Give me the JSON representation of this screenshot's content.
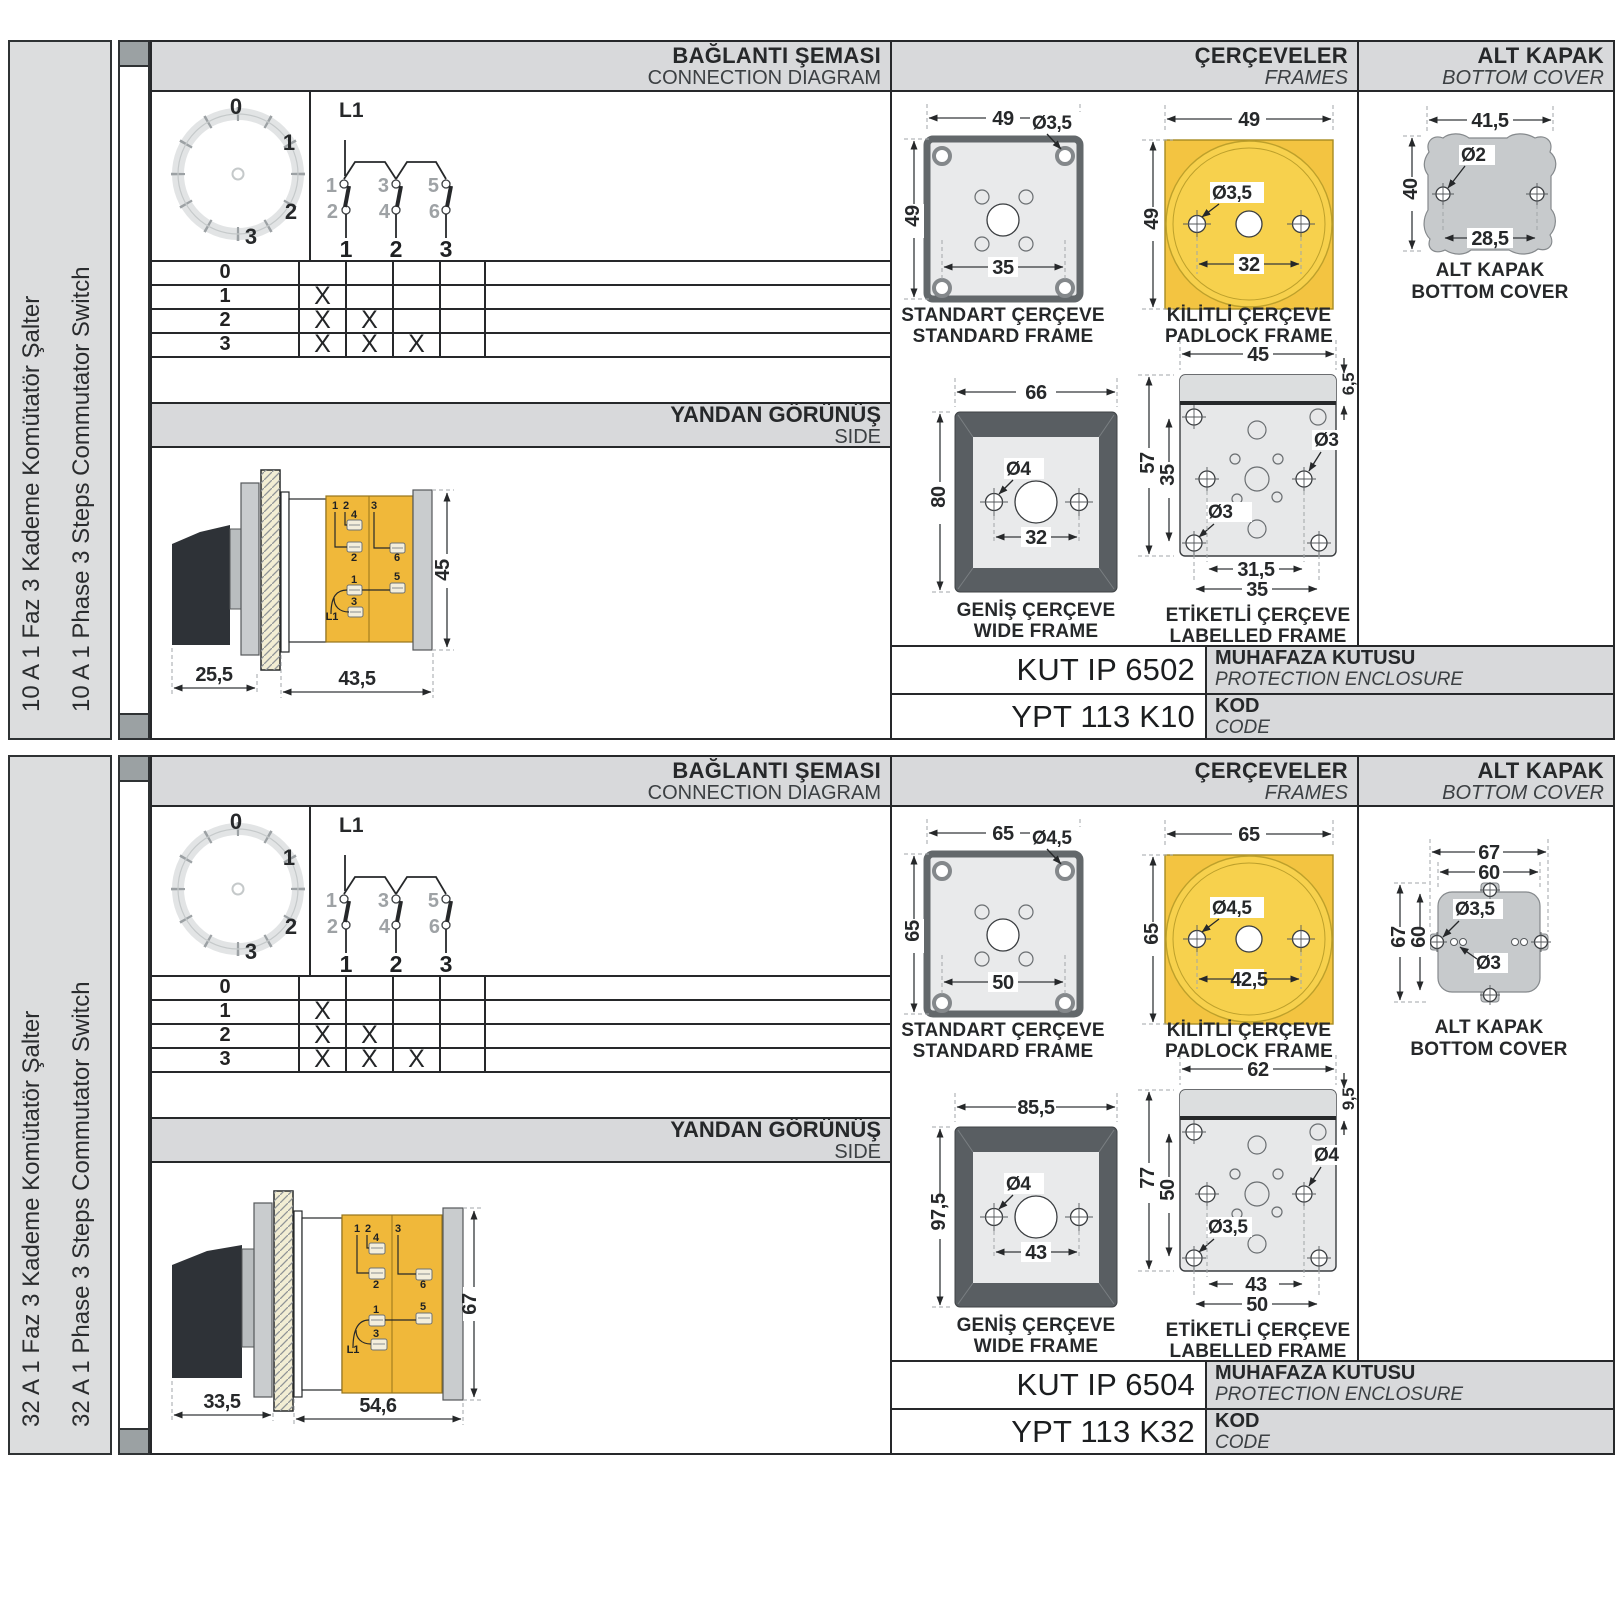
{
  "colors": {
    "accent_yellow": "#F3C441",
    "accent_yellow_light": "#F7D14D",
    "body_yellow": "#F0B83A",
    "header_gray": "#D8D9DB",
    "sidebar_gray": "#DCDDDE",
    "drawing_steel": "#C9CCCE",
    "frame_dark": "#595E62",
    "line_dark": "#26282A"
  },
  "panels": [
    {
      "label_tr": "10 A 1 Faz 3 Kademe Komütatör Şalter",
      "label_en": "10 A 1 Phase 3 Steps Commutator Switch",
      "hdr": {
        "conn_tr": "BAĞLANTI ŞEMASI",
        "conn_en": "CONNECTION DIAGRAM",
        "frames_tr": "ÇERÇEVELER",
        "frames_en": "FRAMES",
        "cover_tr": "ALT KAPAK",
        "cover_en": "BOTTOM COVER"
      },
      "dial": {
        "p0": "0",
        "p1": "1",
        "p2": "2",
        "p3": "3"
      },
      "sch": {
        "input": "L1",
        "c1": "1",
        "c2": "2",
        "c3": "3",
        "c4": "4",
        "c5": "5",
        "c6": "6",
        "o1": "1",
        "o2": "2",
        "o3": "3"
      },
      "table": {
        "rows": [
          {
            "label": "0",
            "marks": [
              "",
              "",
              ""
            ]
          },
          {
            "label": "1",
            "marks": [
              "X",
              "",
              ""
            ]
          },
          {
            "label": "2",
            "marks": [
              "X",
              "X",
              ""
            ]
          },
          {
            "label": "3",
            "marks": [
              "X",
              "X",
              "X"
            ]
          }
        ]
      },
      "side": {
        "title_tr": "YANDAN GÖRÜNÜŞ",
        "title_en": "SIDE",
        "dim1": "25,5",
        "dim2": "43,5",
        "dim3": "45",
        "terms": [
          "1",
          "2",
          "4",
          "2",
          "3",
          "6",
          "1",
          "5",
          "3",
          "L1"
        ]
      },
      "fr": {
        "std": {
          "tr": "STANDART ÇERÇEVE",
          "en": "STANDARD FRAME",
          "w": "49",
          "h": "49",
          "hole": "Ø3,5",
          "span": "35"
        },
        "pad": {
          "tr": "KİLİTLİ ÇERÇEVE",
          "en": "PADLOCK FRAME",
          "w": "49",
          "h": "49",
          "hole": "Ø3,5",
          "span": "32"
        },
        "wide": {
          "tr": "GENİŞ ÇERÇEVE",
          "en": "WIDE FRAME",
          "w": "66",
          "h": "80",
          "hole": "Ø4",
          "span": "32"
        },
        "lab": {
          "tr": "ETİKETLİ ÇERÇEVE",
          "en": "LABELLED FRAME",
          "w": "45",
          "h": "57",
          "inner": "35",
          "strip": "6,5",
          "hole_r": "Ø3",
          "hole_l": "Ø3",
          "span1": "31,5",
          "span2": "35"
        }
      },
      "cover": {
        "tr": "ALT KAPAK",
        "en": "BOTTOM COVER",
        "w": "41,5",
        "h": "40",
        "hole": "Ø2",
        "span": "28,5"
      },
      "codes": {
        "enclosure": "KUT IP 6502",
        "enc_tr": "MUHAFAZA KUTUSU",
        "enc_en": "PROTECTION ENCLOSURE",
        "code": "YPT 113 K10",
        "code_tr": "KOD",
        "code_en": "CODE"
      }
    },
    {
      "label_tr": "32 A 1 Faz 3 Kademe Komütatör Şalter",
      "label_en": "32 A 1 Phase 3 Steps Commutator Switch",
      "hdr": {
        "conn_tr": "BAĞLANTI ŞEMASI",
        "conn_en": "CONNECTION DIAGRAM",
        "frames_tr": "ÇERÇEVELER",
        "frames_en": "FRAMES",
        "cover_tr": "ALT KAPAK",
        "cover_en": "BOTTOM COVER"
      },
      "dial": {
        "p0": "0",
        "p1": "1",
        "p2": "2",
        "p3": "3"
      },
      "sch": {
        "input": "L1",
        "c1": "1",
        "c2": "2",
        "c3": "3",
        "c4": "4",
        "c5": "5",
        "c6": "6",
        "o1": "1",
        "o2": "2",
        "o3": "3"
      },
      "table": {
        "rows": [
          {
            "label": "0",
            "marks": [
              "",
              "",
              ""
            ]
          },
          {
            "label": "1",
            "marks": [
              "X",
              "",
              ""
            ]
          },
          {
            "label": "2",
            "marks": [
              "X",
              "X",
              ""
            ]
          },
          {
            "label": "3",
            "marks": [
              "X",
              "X",
              "X"
            ]
          }
        ]
      },
      "side": {
        "title_tr": "YANDAN GÖRÜNÜŞ",
        "title_en": "SIDE",
        "dim1": "33,5",
        "dim2": "54,6",
        "dim3": "67",
        "terms": [
          "1",
          "2",
          "4",
          "2",
          "3",
          "6",
          "1",
          "5",
          "3",
          "L1"
        ]
      },
      "fr": {
        "std": {
          "tr": "STANDART ÇERÇEVE",
          "en": "STANDARD FRAME",
          "w": "65",
          "h": "65",
          "hole": "Ø4,5",
          "span": "50"
        },
        "pad": {
          "tr": "KİLİTLİ ÇERÇEVE",
          "en": "PADLOCK FRAME",
          "w": "65",
          "h": "65",
          "hole": "Ø4,5",
          "span": "42,5"
        },
        "wide": {
          "tr": "GENİŞ ÇERÇEVE",
          "en": "WIDE FRAME",
          "w": "85,5",
          "h": "97,5",
          "hole": "Ø4",
          "span": "43"
        },
        "lab": {
          "tr": "ETİKETLİ ÇERÇEVE",
          "en": "LABELLED FRAME",
          "w": "62",
          "h": "77",
          "inner": "50",
          "strip": "9,5",
          "hole_r": "Ø4",
          "hole_l": "Ø3,5",
          "span1": "43",
          "span2": "50"
        }
      },
      "cover": {
        "tr": "ALT KAPAK",
        "en": "BOTTOM COVER",
        "w_out": "67",
        "w_in": "60",
        "h_out": "67",
        "h_in": "60",
        "hole1": "Ø3,5",
        "hole2": "Ø3"
      },
      "codes": {
        "enclosure": "KUT IP 6504",
        "enc_tr": "MUHAFAZA KUTUSU",
        "enc_en": "PROTECTION ENCLOSURE",
        "code": "YPT 113 K32",
        "code_tr": "KOD",
        "code_en": "CODE"
      }
    }
  ]
}
